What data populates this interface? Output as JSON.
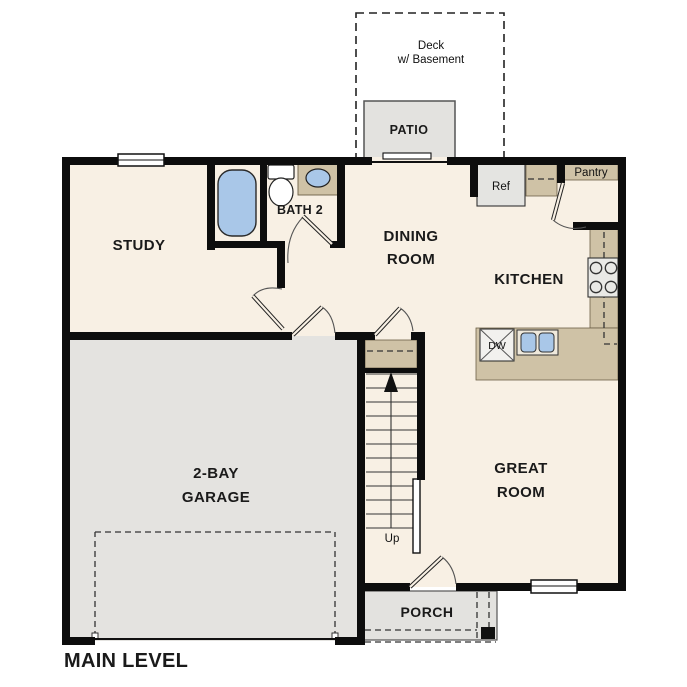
{
  "title": {
    "label": "MAIN LEVEL"
  },
  "rooms": {
    "study": {
      "label": "STUDY"
    },
    "bath2": {
      "label": "BATH 2"
    },
    "dining": {
      "line1": "DINING",
      "line2": "ROOM"
    },
    "kitchen": {
      "label": "KITCHEN"
    },
    "garage": {
      "line1": "2-BAY",
      "line2": "GARAGE"
    },
    "great_room": {
      "line1": "GREAT",
      "line2": "ROOM"
    },
    "porch": {
      "label": "PORCH"
    },
    "patio": {
      "label": "PATIO"
    },
    "deck": {
      "line1": "Deck",
      "line2": "w/ Basement"
    },
    "pantry": {
      "label": "Pantry"
    }
  },
  "fixtures": {
    "refrigerator": {
      "label": "Ref"
    },
    "dishwasher": {
      "label": "DW"
    },
    "stairs_direction": {
      "label": "Up"
    }
  },
  "colors": {
    "floor_cream": "#f8f0e4",
    "floor_gray": "#e4e3e0",
    "counter_tan": "#cfc2a6",
    "fixture_blue": "#a9c7e8",
    "wall_black": "#0d0d0d"
  }
}
